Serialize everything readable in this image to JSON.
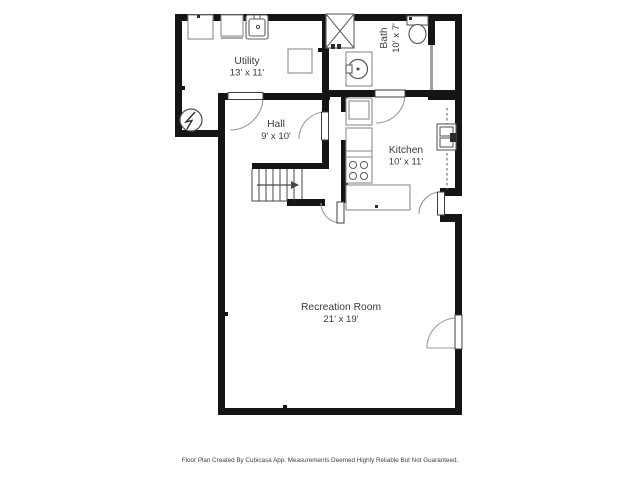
{
  "floor_plan": {
    "rooms": {
      "utility": {
        "name": "Utility",
        "dims": "13' x 11'"
      },
      "hall": {
        "name": "Hall",
        "dims": "9' x 10'"
      },
      "bath": {
        "name": "Bath",
        "dims": "10' x 7'"
      },
      "kitchen": {
        "name": "Kitchen",
        "dims": "10' x 11'"
      },
      "recreation": {
        "name": "Recreation Room",
        "dims": "21' x 19'"
      }
    },
    "fixtures": [
      "washer",
      "dryer",
      "laundry-sink",
      "storage-appliance",
      "water-heater",
      "shower",
      "bathroom-sink",
      "toilet",
      "stove",
      "kitchen-counter",
      "kitchen-peninsula",
      "kitchen-sink",
      "staircase"
    ],
    "colors": {
      "wall": "#151515",
      "fixture_outline": "#8d8d8d",
      "label_text": "#3b3b3b",
      "background": "#ffffff"
    }
  },
  "footer": {
    "disclaimer": "Floor Plan Created By Cubicasa App. Measurements Deemed Highly Reliable But Not Guaranteed."
  }
}
